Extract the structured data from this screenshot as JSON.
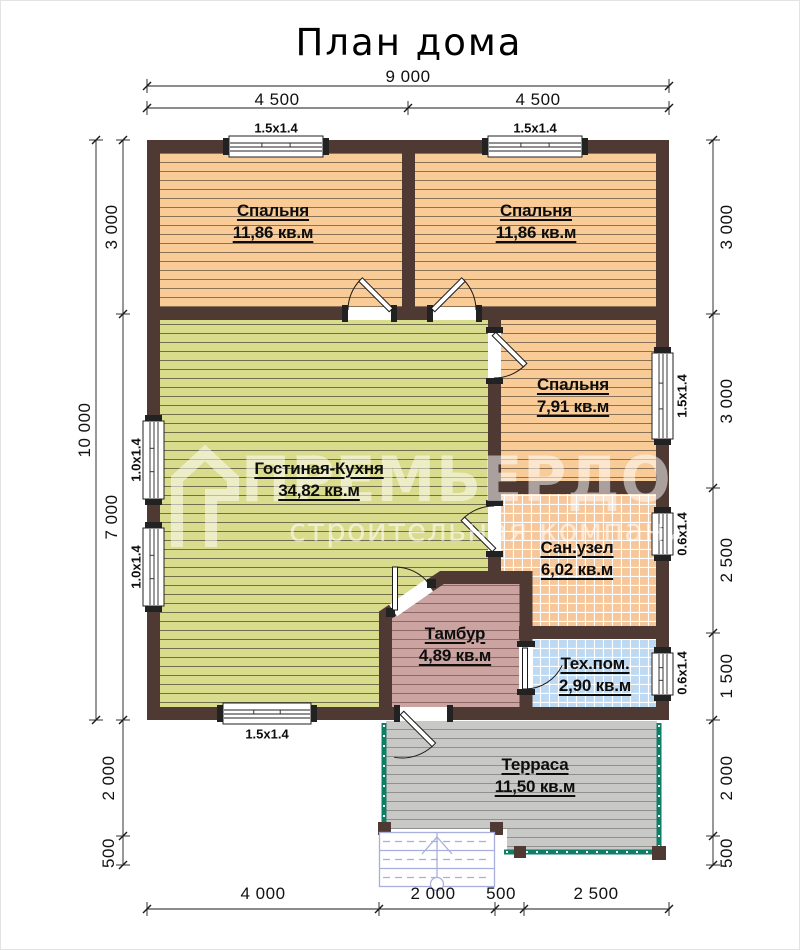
{
  "title": "План дома",
  "watermark": {
    "brand": "ПРЕМЬЕРДОМ",
    "tagline": "строительная компания"
  },
  "rooms": [
    {
      "id": "bedroom-left",
      "name": "Спальня",
      "area": "11,86 кв.м"
    },
    {
      "id": "bedroom-right",
      "name": "Спальня",
      "area": "11,86 кв.м"
    },
    {
      "id": "bedroom-small",
      "name": "Спальня",
      "area": "7,91 кв.м"
    },
    {
      "id": "living-kitchen",
      "name": "Гостиная-Кухня",
      "area": "34,82 кв.м"
    },
    {
      "id": "bathroom",
      "name": "Сан.узел",
      "area": "6,02 кв.м"
    },
    {
      "id": "vestibule",
      "name": "Тамбур",
      "area": "4,89 кв.м"
    },
    {
      "id": "utility",
      "name": "Тех.пом.",
      "area": "2,90 кв.м"
    },
    {
      "id": "terrace",
      "name": "Терраса",
      "area": "11,50 кв.м"
    }
  ],
  "windows": {
    "top_left": "1.5x1.4",
    "top_right": "1.5x1.4",
    "bottom": "1.5x1.4",
    "left_upper": "1.0x1.4",
    "left_lower": "1.0x1.4",
    "right_bedroom": "1.5x1.4",
    "right_bath": "0.6x1.4",
    "right_utility": "0.6x1.4"
  },
  "dimensions": {
    "top_total": "9 000",
    "top_left": "4 500",
    "top_right": "4 500",
    "left_total": "10 000",
    "left_top": "3 000",
    "left_mid": "7 000",
    "left_terrace": "2 000",
    "left_stairs": "500",
    "right_r1": "3 000",
    "right_r2": "3 000",
    "right_r3": "2 500",
    "right_r4": "1 500",
    "right_terrace": "2 000",
    "right_stairs": "500",
    "bottom_b1": "4 000",
    "bottom_b2": "2 000",
    "bottom_b3": "500",
    "bottom_b4": "2 500"
  },
  "colors": {
    "wall": "#4e3a32",
    "bedroom_fill": "#f8cb97",
    "living_fill": "#dadc8d",
    "vestibule_fill": "#cba4a2",
    "bath_fill": "#f5c79b",
    "utility_fill": "#bed9f2",
    "terrace_fill": "#c8c8c6",
    "railing": "#0e7e66",
    "stairs": "#a9afdd"
  }
}
